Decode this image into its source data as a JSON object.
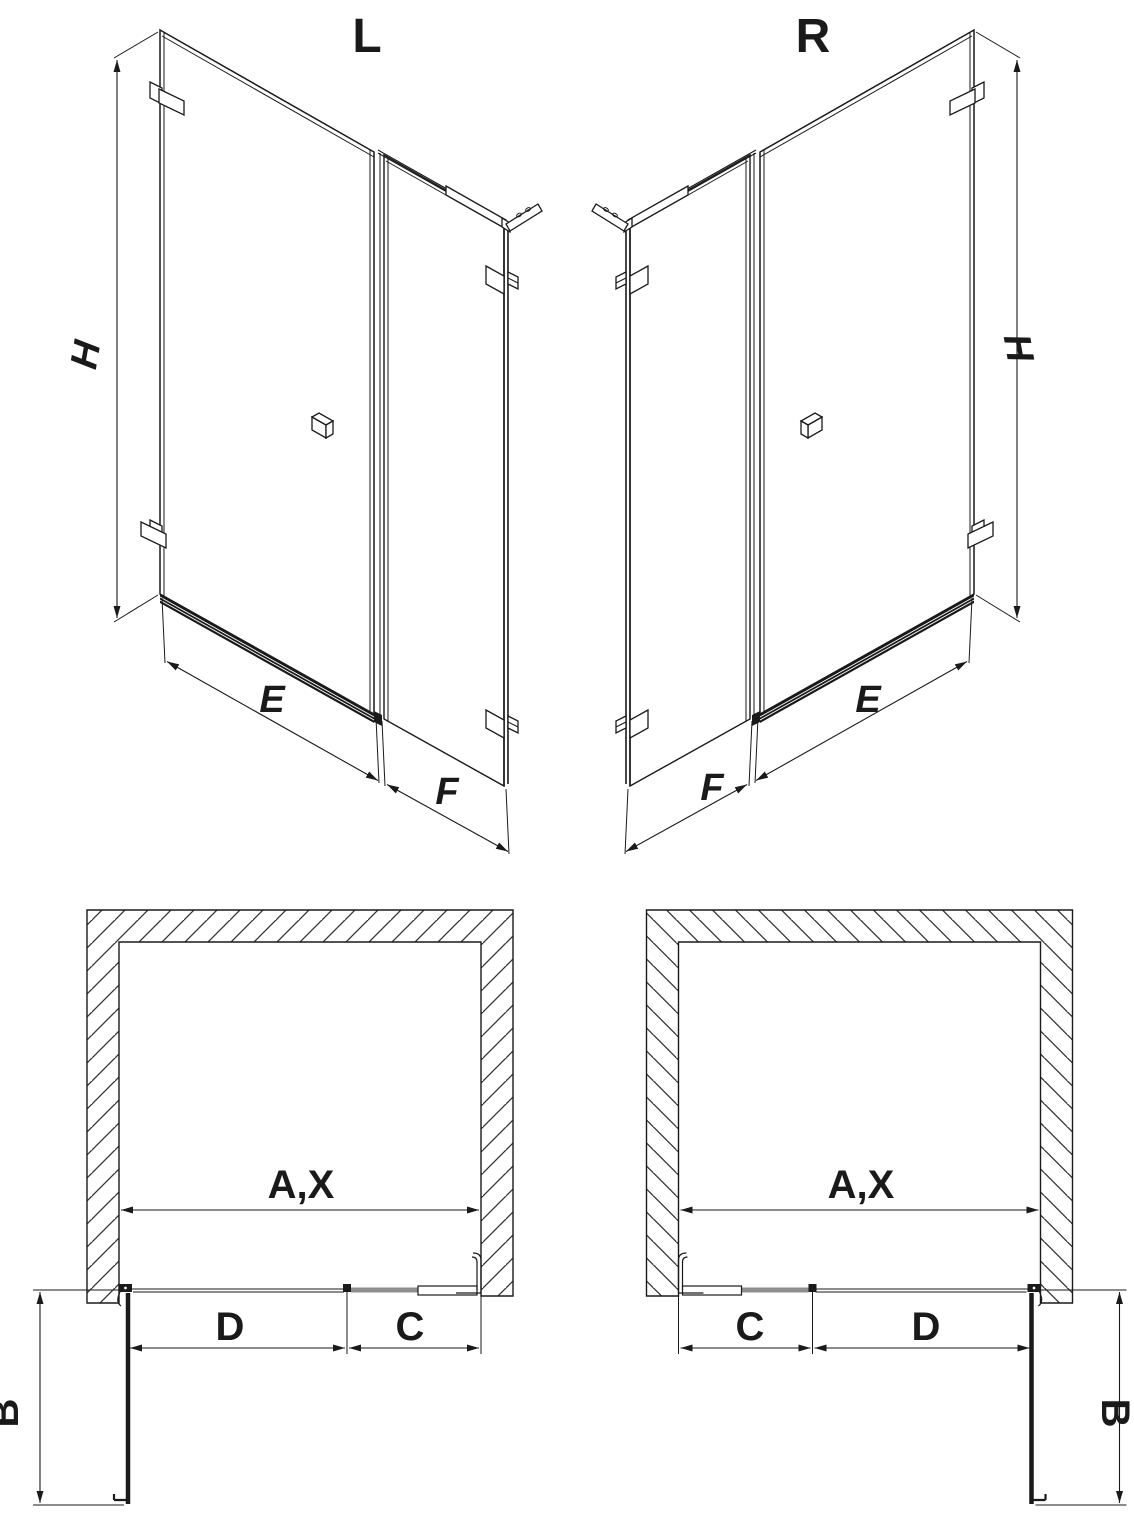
{
  "drawing": {
    "iso_left": {
      "title": "L",
      "height": "H",
      "door_width": "E",
      "panel_width": "F"
    },
    "iso_right": {
      "title": "R",
      "height": "H",
      "door_width": "E",
      "panel_width": "F"
    },
    "plan_left": {
      "opening": "A,X",
      "door": "D",
      "panel": "C",
      "swing": "B"
    },
    "plan_right": {
      "opening": "A,X",
      "door": "D",
      "panel": "C",
      "swing": "B"
    }
  },
  "colors": {
    "line": "#1a1a1a",
    "panel_gray": "#8f8f8f",
    "hatch": "#333333",
    "background": "#ffffff"
  }
}
